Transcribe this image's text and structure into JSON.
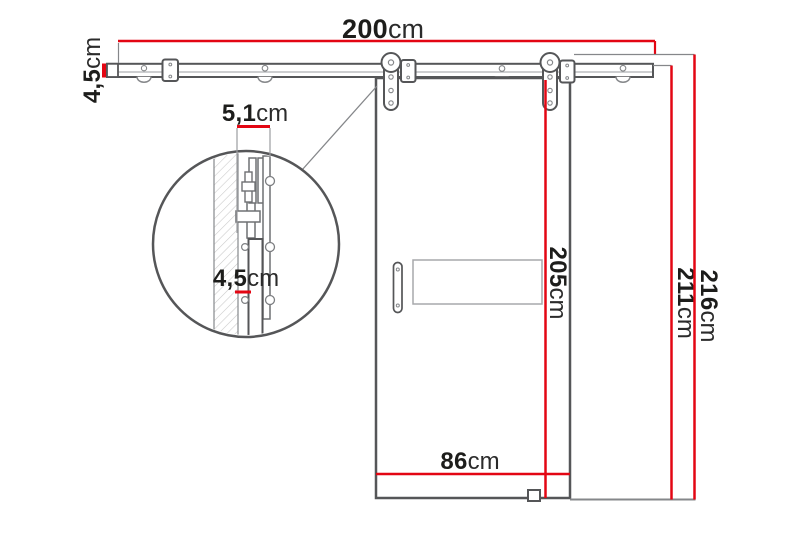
{
  "diagram": {
    "kind": "technical-drawing",
    "subject": "sliding barn door with wall-mounted top rail system",
    "colors": {
      "dimension_red": "#e30613",
      "outline_dark": "#555658",
      "outline_mid": "#85878a",
      "outline_light": "#a7a9ac",
      "text": "#1d1d1b",
      "background": "#ffffff"
    },
    "dimensions": {
      "rail_length": {
        "value": "200",
        "unit": "cm"
      },
      "rail_profile_height": {
        "value": "4,5",
        "unit": "cm"
      },
      "detail_wall_offset": {
        "value": "5,1",
        "unit": "cm"
      },
      "detail_rail_height": {
        "value": "4,5",
        "unit": "cm"
      },
      "door_height": {
        "value": "205",
        "unit": "cm"
      },
      "door_width": {
        "value": "86",
        "unit": "cm"
      },
      "height_under_rail": {
        "value": "211",
        "unit": "cm"
      },
      "total_height": {
        "value": "216",
        "unit": "cm"
      }
    }
  }
}
